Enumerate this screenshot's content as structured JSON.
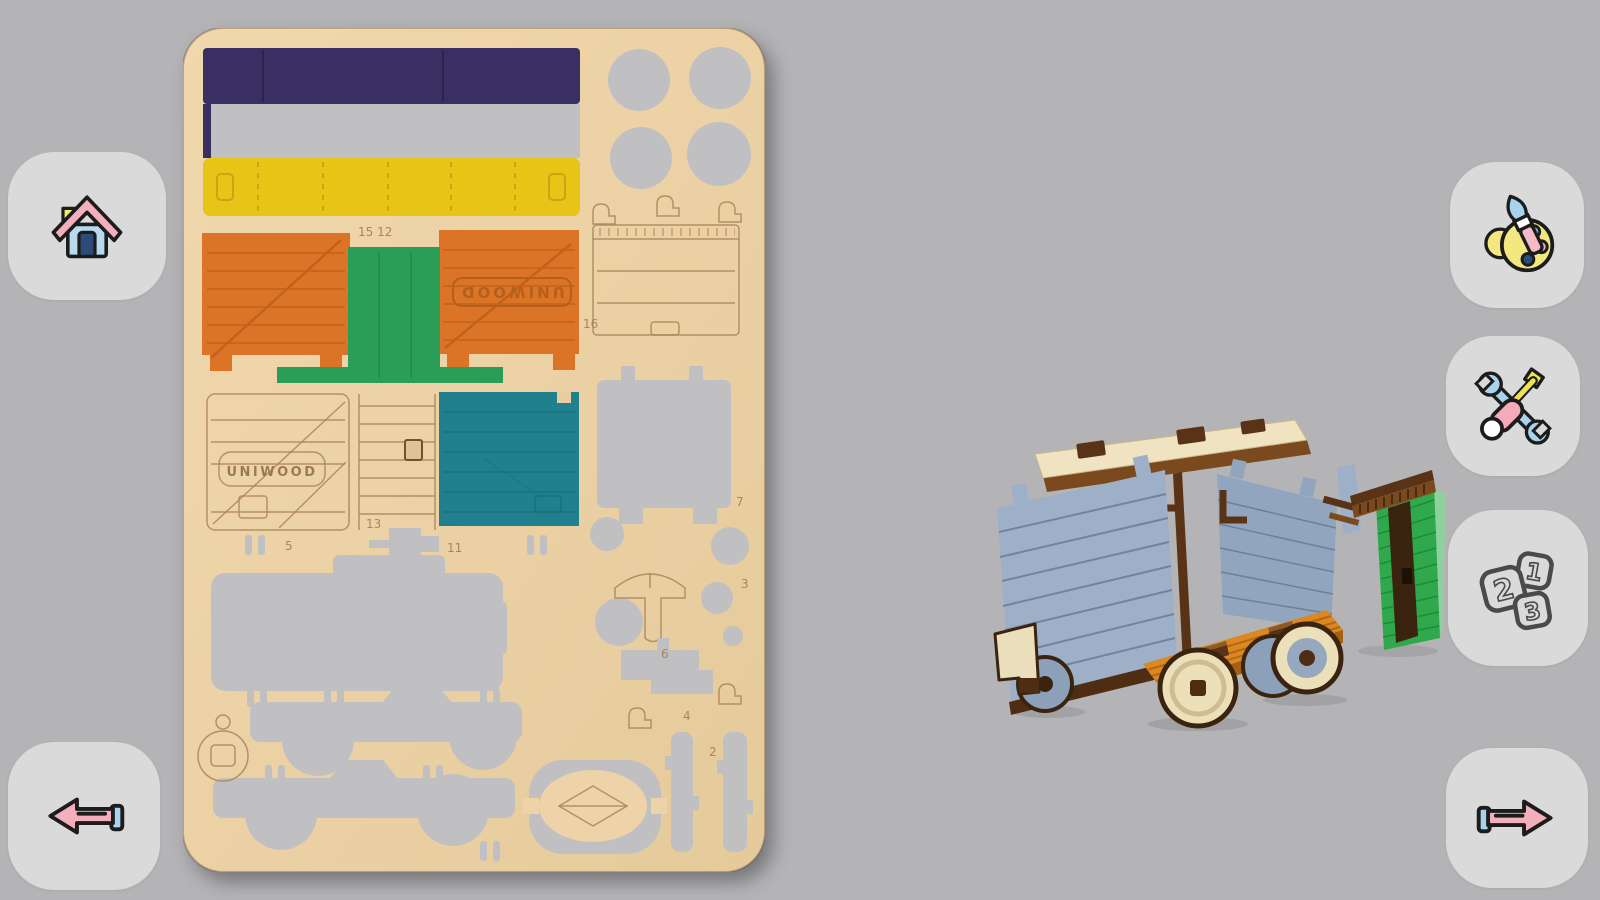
{
  "screen": {
    "background": "#b4b4b6"
  },
  "buttons": {
    "home": {
      "icon": "home-icon"
    },
    "back": {
      "icon": "arrow-left-icon"
    },
    "paint": {
      "icon": "palette-brush-icon"
    },
    "assemble": {
      "icon": "wrench-screwdriver-icon"
    },
    "steps": {
      "icon": "numbered-cards-icon",
      "card_numbers": [
        "1",
        "2",
        "3"
      ]
    },
    "next": {
      "icon": "arrow-right-icon"
    }
  },
  "board": {
    "brand": "UNIWOOD",
    "brand_mirrored": "UNIWOOD",
    "wood_color": "#ecd2a6",
    "cutout_color": "#c0c0c3",
    "pieces": {
      "navy_band": "#3a2f63",
      "yellow_band": "#e6c517",
      "orange_panel": "#dc7427",
      "green_strip": "#2a9e57",
      "teal_panel": "#20808e"
    },
    "part_numbers": {
      "p15_12": "15 12",
      "p16": "16",
      "p13": "13",
      "p11": "11",
      "p5": "5",
      "p7": "7",
      "p3": "3",
      "p6": "6",
      "p4": "4",
      "p2": "2"
    }
  },
  "model": {
    "subject": "partially assembled wagon",
    "colors": {
      "wall": "#9db0c8",
      "floor": "#dd8722",
      "frame": "#4f2d12",
      "roof": "#efe3c2",
      "wheel": "#ece0bb",
      "door": "#2fa94c"
    }
  }
}
